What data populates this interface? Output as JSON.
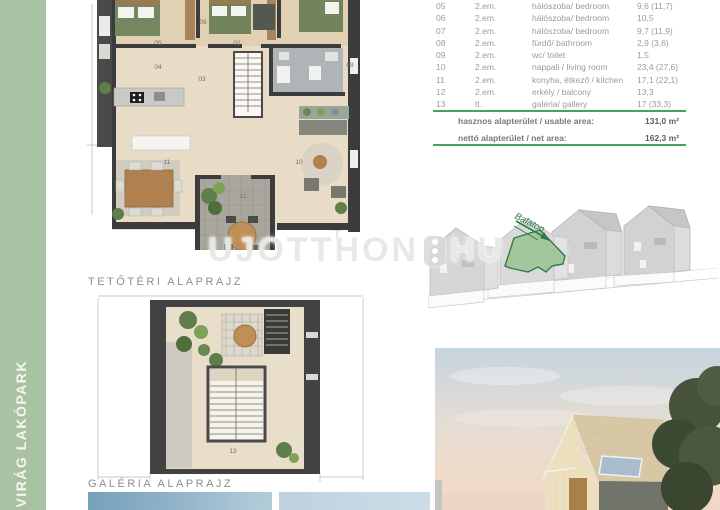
{
  "sidebar": {
    "label": "VIRÁG LAKÓPARK"
  },
  "captions": {
    "plan1": "TETŐTÉRI ALAPRAJZ",
    "plan2": "GALÉRIA ALAPRAJZ"
  },
  "watermark": {
    "left": "UJOTTHON",
    "right": "HU"
  },
  "site_plan": {
    "direction_label": "Balaton"
  },
  "area_table": {
    "rows": [
      {
        "no": "05",
        "floor": "2.em.",
        "name": "hálószoba/ bedroom",
        "area": "9,6 (11,7)"
      },
      {
        "no": "06",
        "floor": "2.em.",
        "name": "hálószoba/ bedroom",
        "area": "10,5"
      },
      {
        "no": "07",
        "floor": "2.em.",
        "name": "hálószoba/ bedroom",
        "area": "9,7 (11,9)"
      },
      {
        "no": "08",
        "floor": "2.em.",
        "name": "fürdő/ bathroom",
        "area": "2,9 (3,6)"
      },
      {
        "no": "09",
        "floor": "2.em.",
        "name": "wc/ toilet",
        "area": "1,5"
      },
      {
        "no": "10",
        "floor": "2.em.",
        "name": "nappali / living room",
        "area": "23,4 (27,6)"
      },
      {
        "no": "11",
        "floor": "2.em.",
        "name": "konyha, étkező / kitchen",
        "area": "17,1 (22,1)"
      },
      {
        "no": "12",
        "floor": "2.em.",
        "name": "erkély / balcony",
        "area": "13,3"
      },
      {
        "no": "13",
        "floor": "tt.",
        "name": "galéria/ gallery",
        "area": "17 (33,3)"
      }
    ],
    "summary": [
      {
        "label": "hasznos alapterület / usable area:",
        "value": "131,0 m²"
      },
      {
        "label": "nettó alapterület / net area:",
        "value": "162,3 m²"
      }
    ]
  },
  "plan1_room_labels": [
    {
      "text": "09",
      "x": 203,
      "y": 23
    },
    {
      "text": "05",
      "x": 158,
      "y": 44
    },
    {
      "text": "02",
      "x": 237,
      "y": 44
    },
    {
      "text": "04",
      "x": 158,
      "y": 68
    },
    {
      "text": "08",
      "x": 350,
      "y": 66
    },
    {
      "text": "03",
      "x": 202,
      "y": 80
    },
    {
      "text": "11",
      "x": 167,
      "y": 163
    },
    {
      "text": "10",
      "x": 299,
      "y": 163
    },
    {
      "text": "12",
      "x": 243,
      "y": 197
    }
  ],
  "plan2_room_labels": [
    {
      "text": "13",
      "x": 233,
      "y": 452
    }
  ],
  "colors": {
    "sidebar_green": "#a9c2a3",
    "table_rule_green": "#4aa05e",
    "balaton_green": "#2f7b4b",
    "highlight_roof_green": "#a3c69d"
  }
}
